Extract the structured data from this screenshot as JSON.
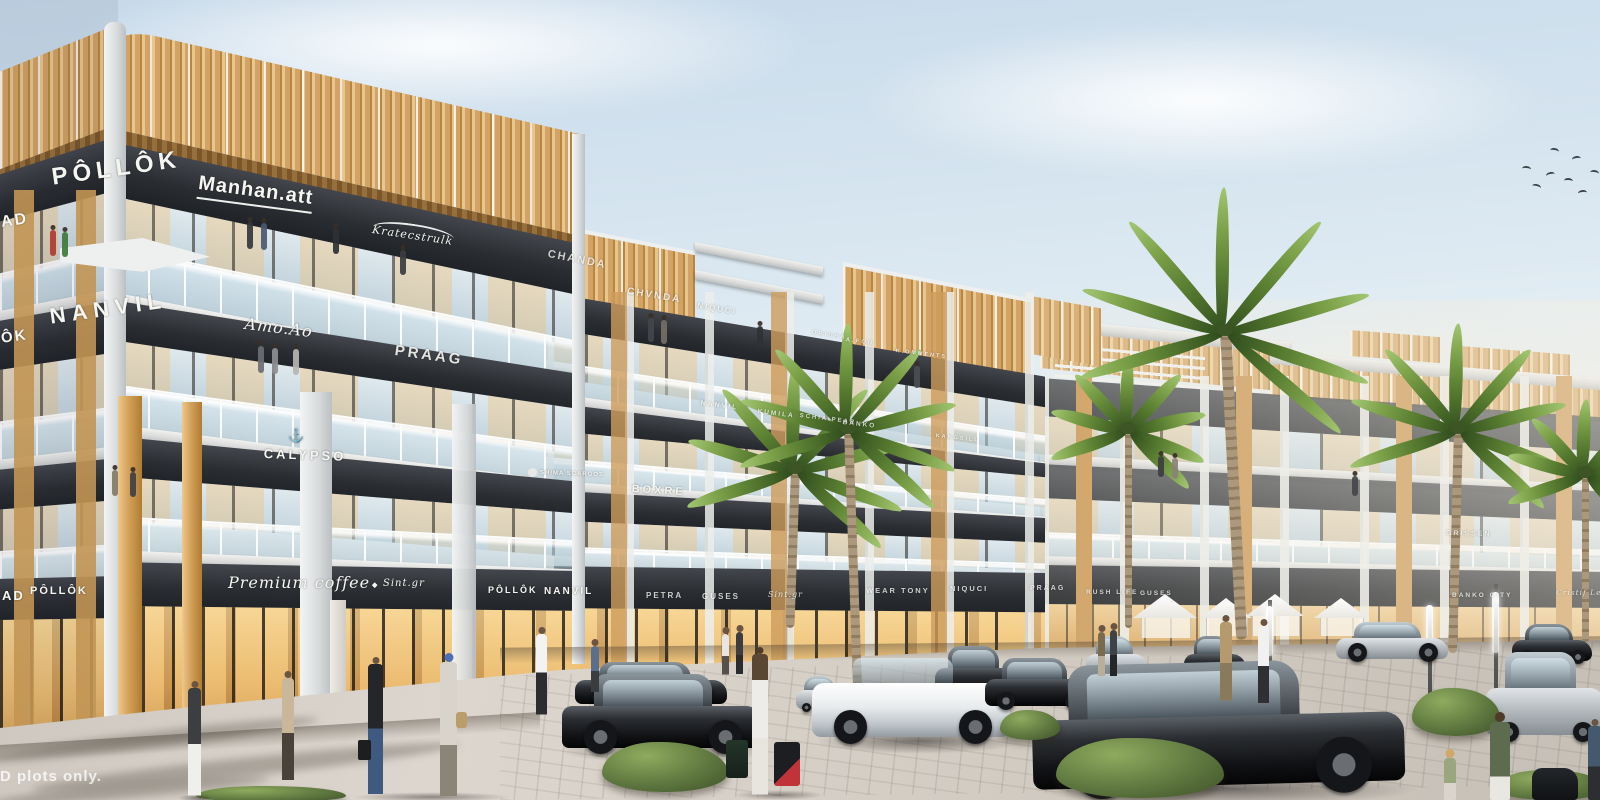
{
  "scene": {
    "description": "Daytime architectural rendering of a multi-storey wooden-slat retail plaza with balconies, palm trees, parking lot with cars, market tents and pedestrians",
    "watermark": "D plots only."
  },
  "signs": {
    "side_pollok": "PÔLLÔK",
    "side_ad": "AD",
    "side_nanvil": "NANVIL",
    "side_pollok_partial": "ÔK",
    "manhanatt": "Manhan.att",
    "kratec": "Kratecstrulk",
    "amoao": "Amo.Ao",
    "praag": "PRAAG",
    "calypso": "CALYPSO",
    "calypso_icon": "⚓",
    "shima": "SHIMA SCARGOS",
    "chanda": "CHANDA",
    "chvnda": "CHVNDA",
    "niquci_upper": "NIQUCI",
    "orisha": "ORISHA",
    "afon": "A.FON",
    "komments": "K.OMMENTS",
    "nanvil_balcony": "NANVIL",
    "kumila": "KUMILA",
    "schia_pear": "SCHIA PEAR",
    "banko": "BANKO",
    "kangsill": "KANGSILL",
    "boxre": "BOXRE",
    "grissen": "GRISSEN",
    "ground": {
      "ad": "AD",
      "pollok1": "PÔLLÔK",
      "premium": "Premium coffee",
      "sint1": "Sint.gr",
      "sint_icon": "◆",
      "pollok2": "PÔLLÔK",
      "nanvil": "NANVIL",
      "petra": "PETRA",
      "guses": "GUSES",
      "sint2": "Sint.gr",
      "wear": "WEAR TONY",
      "niquci": "NIQUCI",
      "praag2": "PRAAG",
      "rush": "RUSH LIFE",
      "guses2": "GUSES",
      "banko_city": "BANKO CITY",
      "crist": "Cristif Lebleme"
    }
  },
  "palette": {
    "sky_top": "#c6d9ea",
    "sky_low": "#f2f5f3",
    "wood": "#d2a266",
    "wood_light": "#e8c68d",
    "wood_dark": "#b5873f",
    "concrete": "#e9eaea",
    "sign_band": "#2a2d31",
    "storefront_glow": "#e3ac60",
    "glass": "#c3d3dc",
    "palm_green": "#577b30",
    "pavement": "#d4cdc4",
    "hedge": "#5f7840",
    "car_black": "#121316",
    "car_white": "#e8ebed",
    "car_silver": "#b6bcc0"
  }
}
